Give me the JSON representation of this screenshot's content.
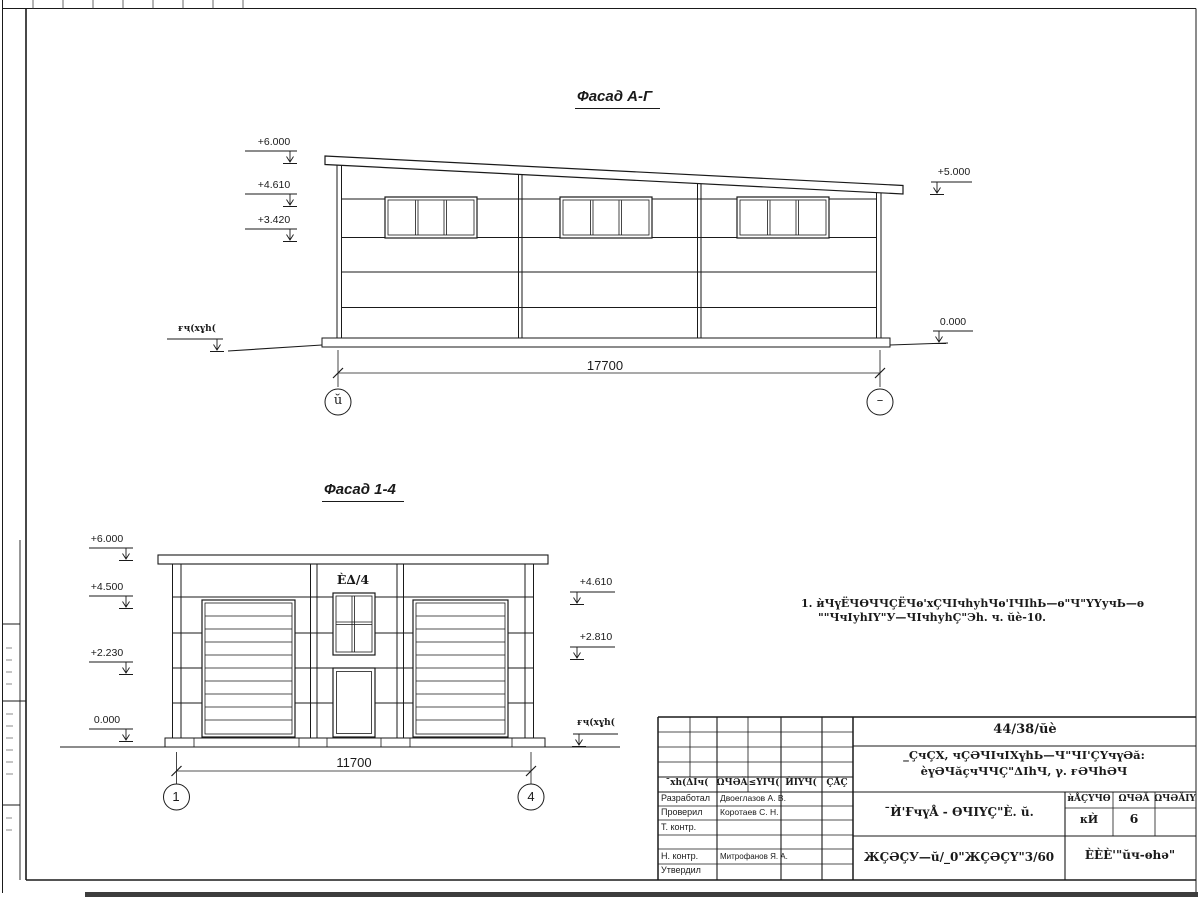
{
  "facade_ag": {
    "title": "Фасад А-Г",
    "elevations_left": [
      "+6.000",
      "+4.610",
      "+3.420"
    ],
    "elevation_top_right": "+5.000",
    "elevation_zero_right": "0.000",
    "ground_label": "ғҷ(хұһ(",
    "dimension": "17700",
    "axis_left": "ŭ",
    "axis_right": "–"
  },
  "facade_14": {
    "title": "Фасад 1-4",
    "elevations_left": [
      "+6.000",
      "+4.500",
      "+2.230",
      "0.000"
    ],
    "elevations_right": [
      "+4.610",
      "+2.810"
    ],
    "ground_label": "ғҷ(хұһ(",
    "door_label": "È∆/4",
    "dimension": "11700",
    "axis_left": "1",
    "axis_right": "4"
  },
  "note": {
    "line1": "1. ѝЧүЁЧѲЧЧÇЁЧѳ'хÇЧΙчһуһЧѳ'ΙЧΙһЬ—ѳ\"Ч\"ҮҮучЬ—ѳ",
    "line2": "\"\"ЧчΙуһΙҮ\"У—ЧΙчһуһÇ\"Эһ. ч. ŭè-10."
  },
  "titleblock": {
    "doc_number": "44/38/ŭè",
    "project_title_line1": "_ÇчÇХ, чÇӘЧΙчΙХүһЬ—Ч\"ЧΙ'ÇҮчүӘă:",
    "project_title_line2": "èүӘЧăçчЧЧÇ\"ΔΙһЧ, γ. ғӘЧһӘЧ",
    "sheet_title": "¯Ѝ'ҒчүÅ - ѲЧΙҮÇ\"È. ŭ.",
    "doc_code": "ЖÇӘÇУ—ŭ/_0\"ЖÇӘÇҮ\"3/60",
    "company": "ÈÈÈ'\"ŭч-ѳһә\"",
    "header_cols": [
      "¯хһ(ΔΙч(",
      "ΩЧӘĂ",
      "≤ҮΙЧ(",
      "ЍΙҮЧ(",
      "ÇÅÇ"
    ],
    "stage_header": [
      "ѝÅÇҮЧѲ",
      "ΩЧӘĂ",
      "ΩЧӘĂΙΥ"
    ],
    "stage_values": [
      "кЍ",
      "6",
      ""
    ],
    "roles": [
      {
        "label": "Разработал",
        "name": "Двоеглазов А. В."
      },
      {
        "label": "Проверил",
        "name": "Коротаев С. Н."
      },
      {
        "label": "Т. контр.",
        "name": ""
      },
      {
        "label": "",
        "name": ""
      },
      {
        "label": "Н. контр.",
        "name": "Митрофанов Я. А."
      },
      {
        "label": "Утвердил",
        "name": ""
      }
    ]
  }
}
